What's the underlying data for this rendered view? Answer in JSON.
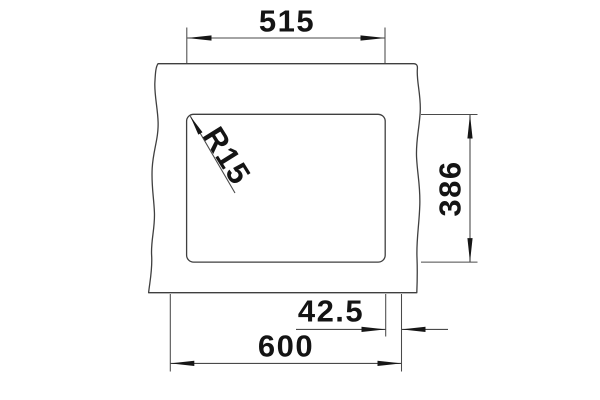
{
  "drawing": {
    "title": "sink-cutout-dimension-drawing",
    "view": "top-view-countertop-cutout",
    "units": "mm",
    "dimensions": {
      "cutout_width": "515",
      "cutout_depth": "386",
      "corner_radius": "R15",
      "edge_offset": "42.5",
      "overall_width": "600"
    },
    "colors": {
      "background": "#ffffff",
      "line": "#3f3f3f",
      "dimension_line": "#4a4a4a",
      "text": "#141414"
    }
  }
}
